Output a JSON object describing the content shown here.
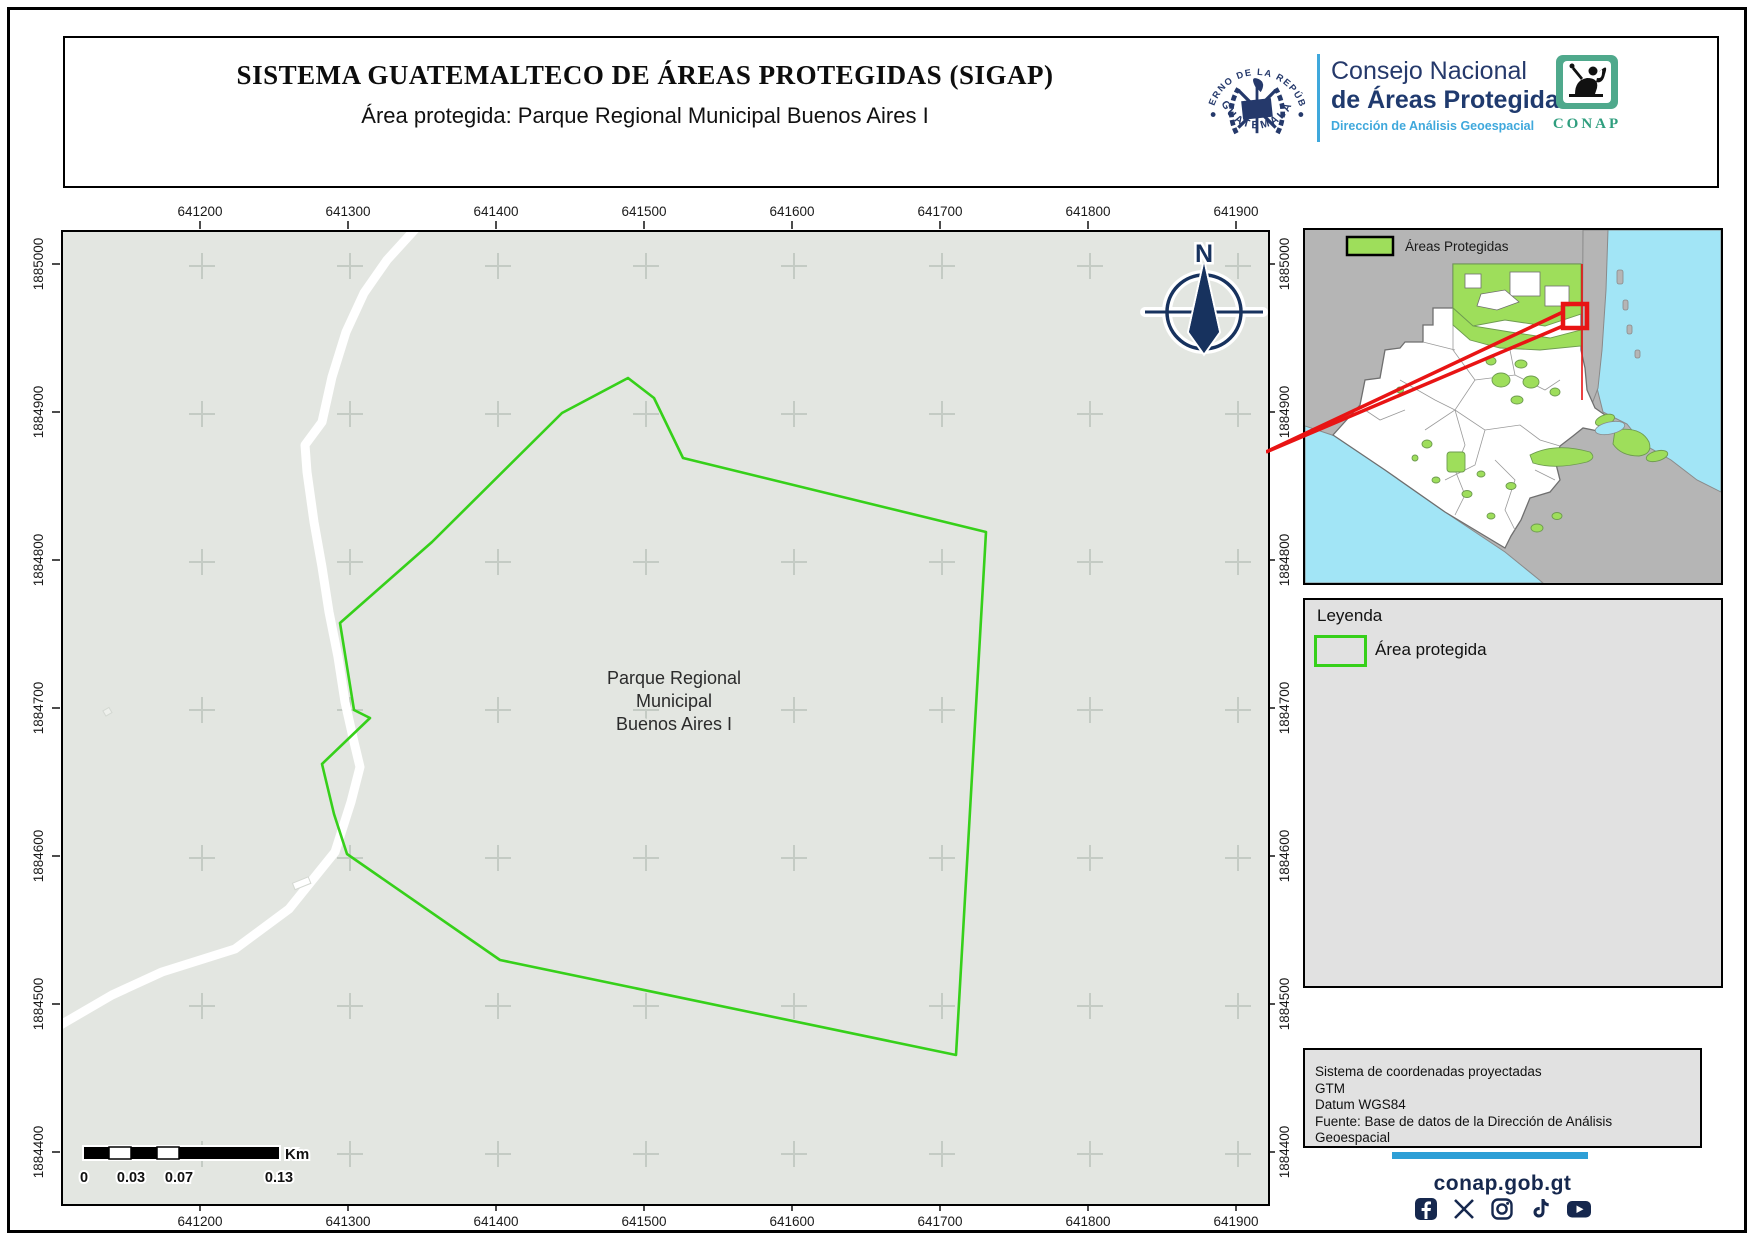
{
  "header": {
    "title": "SISTEMA GUATEMALTECO DE ÁREAS PROTEGIDAS  (SIGAP)",
    "subtitle": "Área protegida: Parque Regional Municipal Buenos Aires I",
    "seal_text_top": "GOBIERNO DE LA REPÚBLICA",
    "seal_text_bottom": "GUATEMALA",
    "org_line1": "Consejo Nacional",
    "org_line2": "de Áreas Protegidas",
    "org_line3": "Dirección de Análisis Geoespacial",
    "conap_wordmark": "CONAP"
  },
  "map": {
    "north_label": "N",
    "area_label_line1": "Parque Regional",
    "area_label_line2": "Municipal",
    "area_label_line3": "Buenos Aires I",
    "x_axis_labels": [
      "641200",
      "641300",
      "641400",
      "641500",
      "641600",
      "641700",
      "641800",
      "641900"
    ],
    "y_axis_labels": [
      "1885000",
      "1884900",
      "1884800",
      "1884700",
      "1884600",
      "1884500",
      "1884400"
    ],
    "scalebar": {
      "tick_labels": [
        "0",
        "0.03",
        "0.07",
        "0.13"
      ],
      "unit": "Km"
    }
  },
  "inset": {
    "legend_label": "Áreas Protegidas"
  },
  "legend": {
    "title": "Leyenda",
    "item_label": "Área protegida"
  },
  "info_box": {
    "lines": [
      "Sistema de coordenadas proyectadas",
      "GTM",
      "Datum WGS84",
      "Fuente: Base de datos de la Dirección de Análisis Geoespacial"
    ]
  },
  "footer": {
    "website": "conap.gob.gt",
    "social_icons": [
      "facebook",
      "x",
      "instagram",
      "tiktok",
      "youtube"
    ]
  },
  "colors": {
    "navy": "#1f3a6e",
    "footer_navy": "#16284e",
    "light_blue": "#3fa8dc",
    "footer_blue_bar": "#2e9fd6",
    "protected_area_green": "#36d01a",
    "inset_protected_green": "#9ede5b",
    "water_cyan": "#a2e5f6",
    "neighbor_gray": "#b5b5b5",
    "map_background": "#e3e6e1",
    "highlight_red": "#e81414"
  }
}
